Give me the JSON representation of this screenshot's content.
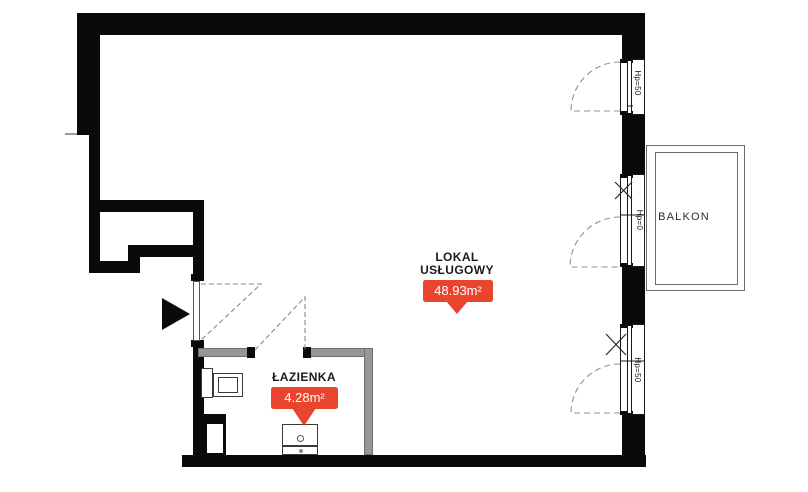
{
  "plan": {
    "title": "floor-plan",
    "rooms": [
      {
        "id": "lokal-uslugowy",
        "name_line1": "LOKAL",
        "name_line2": "USŁUGOWY",
        "area": "48.93m²"
      },
      {
        "id": "lazienka",
        "name": "ŁAZIENKA",
        "area": "4.28m²"
      },
      {
        "id": "balkon",
        "name": "BALKON"
      }
    ],
    "windows": [
      {
        "id": "window-top-right",
        "label": "Hp=50"
      },
      {
        "id": "balcony-door",
        "label": "Hp=0"
      },
      {
        "id": "window-bottom-right",
        "label": "Hp=50"
      }
    ],
    "colors": {
      "wall": "#0a0a0a",
      "partition_gray": "#969696",
      "badge_red": "#e8442e",
      "dash_gray": "#8a8a8a"
    }
  }
}
